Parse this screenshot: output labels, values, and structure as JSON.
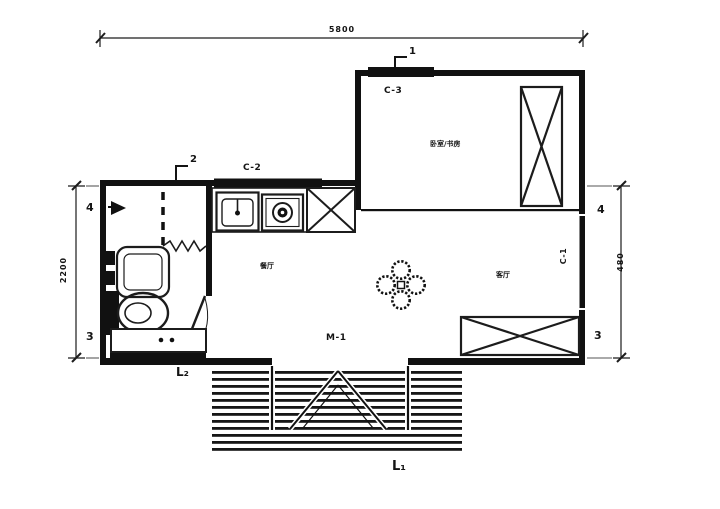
{
  "plan": {
    "dimensions": {
      "width_top": "5800",
      "height_left": "2200",
      "height_right": "480"
    },
    "section_markers": {
      "one": "1",
      "two": "2"
    },
    "elevation_markers": {
      "left_top": "4",
      "left_bottom": "3",
      "right_top": "4",
      "right_bottom": "3"
    },
    "windows": {
      "c1": "C-1",
      "c2": "C-2",
      "c3": "C-3"
    },
    "door": {
      "m1": "M-1"
    },
    "levels": {
      "l1": "L₁",
      "l2": "L₂"
    },
    "rooms": {
      "bedroom_study": "卧室/书房",
      "dining": "餐厅",
      "living": "客厅"
    },
    "colors": {
      "line": "#1c1c1c",
      "fill": "#111111",
      "paper": "#ffffff"
    }
  }
}
